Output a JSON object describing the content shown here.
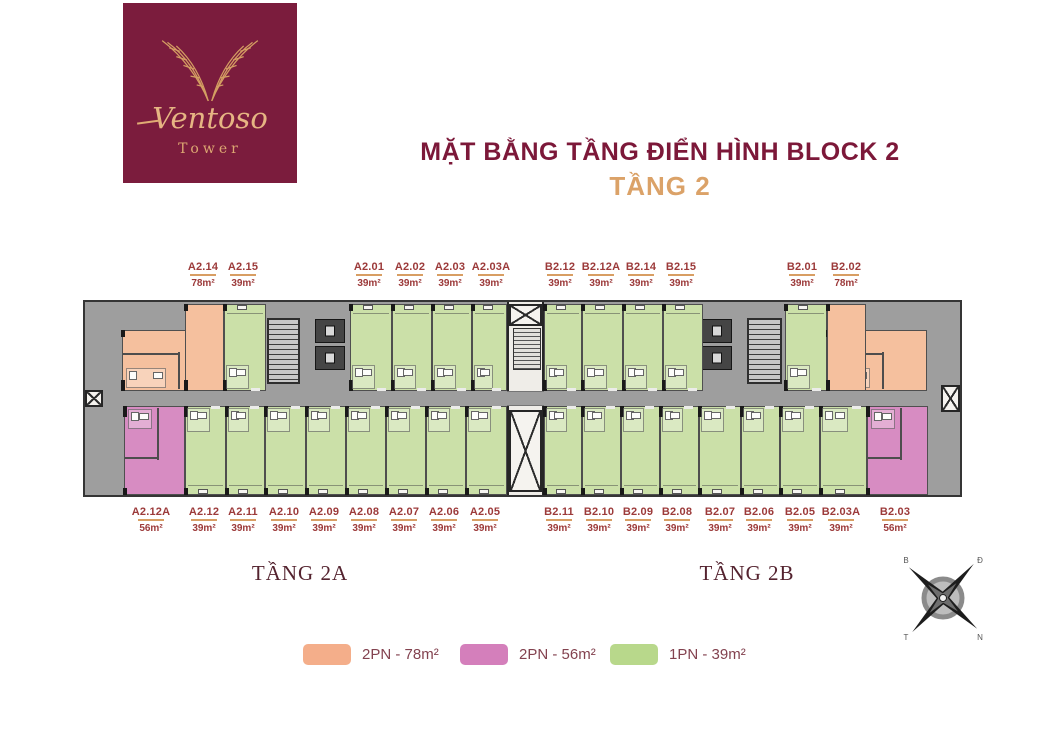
{
  "logo": {
    "brand": "Ventoso",
    "sub": "Tower"
  },
  "title": "MẶT BẰNG TẦNG ĐIỂN HÌNH BLOCK 2",
  "subtitle": "TẦNG 2",
  "wings": {
    "left": "TẦNG 2A",
    "right": "TẦNG 2B"
  },
  "legend": [
    {
      "label": "2PN - 78m²",
      "color": "#f4ae8a",
      "type": "2PN-78"
    },
    {
      "label": "2PN - 56m²",
      "color": "#d47fbb",
      "type": "2PN-56"
    },
    {
      "label": "1PN - 39m²",
      "color": "#b8d88b",
      "type": "1PN-39"
    }
  ],
  "compass": {
    "nw": "B",
    "ne": "Đ",
    "sw": "T",
    "se": "N"
  },
  "colors": {
    "2PN-78": "#f5c09e",
    "2PN-56": "#d78cc2",
    "1PN-39": "#cbe0a8",
    "corridor": "#9e9e9e",
    "wall": "#353535",
    "label_red": "#9c3a3a",
    "rule_gold": "#d89e63",
    "maroon": "#7c1839",
    "gold": "#dba268"
  },
  "plan": {
    "units_top": [
      {
        "id": "A2.14",
        "area": "78m²",
        "type": "2PN-78",
        "rects": [
          [
            37,
            28,
            102,
            61
          ],
          [
            100,
            2,
            39,
            87
          ]
        ],
        "label_x": 203
      },
      {
        "id": "A2.15",
        "area": "39m²",
        "type": "1PN-39",
        "rects": [
          [
            139,
            2,
            42,
            87
          ]
        ],
        "label_x": 243
      },
      {
        "id": "A2.01",
        "area": "39m²",
        "type": "1PN-39",
        "rects": [
          [
            265,
            2,
            42,
            87
          ]
        ],
        "label_x": 369
      },
      {
        "id": "A2.02",
        "area": "39m²",
        "type": "1PN-39",
        "rects": [
          [
            307,
            2,
            40,
            87
          ]
        ],
        "label_x": 410
      },
      {
        "id": "A2.03",
        "area": "39m²",
        "type": "1PN-39",
        "rects": [
          [
            347,
            2,
            40,
            87
          ]
        ],
        "label_x": 450
      },
      {
        "id": "A2.03A",
        "area": "39m²",
        "type": "1PN-39",
        "rects": [
          [
            387,
            2,
            35,
            87
          ]
        ],
        "label_x": 491
      },
      {
        "id": "B2.12",
        "area": "39m²",
        "type": "1PN-39",
        "rects": [
          [
            459,
            2,
            38,
            87
          ]
        ],
        "label_x": 560
      },
      {
        "id": "B2.12A",
        "area": "39m²",
        "type": "1PN-39",
        "rects": [
          [
            497,
            2,
            41,
            87
          ]
        ],
        "label_x": 601
      },
      {
        "id": "B2.14",
        "area": "39m²",
        "type": "1PN-39",
        "rects": [
          [
            538,
            2,
            40,
            87
          ]
        ],
        "label_x": 641
      },
      {
        "id": "B2.15",
        "area": "39m²",
        "type": "1PN-39",
        "rects": [
          [
            578,
            2,
            40,
            87
          ]
        ],
        "label_x": 681
      },
      {
        "id": "B2.01",
        "area": "39m²",
        "type": "1PN-39",
        "rects": [
          [
            700,
            2,
            42,
            87
          ]
        ],
        "label_x": 802
      },
      {
        "id": "B2.02",
        "area": "78m²",
        "type": "2PN-78",
        "rects": [
          [
            742,
            28,
            100,
            61
          ],
          [
            742,
            2,
            39,
            87
          ]
        ],
        "label_x": 846
      }
    ],
    "units_bottom": [
      {
        "id": "A2.12A",
        "area": "56m²",
        "type": "2PN-56",
        "rects": [
          [
            39,
            104,
            61,
            89
          ]
        ],
        "label_x": 151
      },
      {
        "id": "A2.12",
        "area": "39m²",
        "type": "1PN-39",
        "rects": [
          [
            100,
            104,
            41,
            89
          ]
        ],
        "label_x": 204
      },
      {
        "id": "A2.11",
        "area": "39m²",
        "type": "1PN-39",
        "rects": [
          [
            141,
            104,
            39,
            89
          ]
        ],
        "label_x": 243
      },
      {
        "id": "A2.10",
        "area": "39m²",
        "type": "1PN-39",
        "rects": [
          [
            180,
            104,
            41,
            89
          ]
        ],
        "label_x": 284
      },
      {
        "id": "A2.09",
        "area": "39m²",
        "type": "1PN-39",
        "rects": [
          [
            221,
            104,
            40,
            89
          ]
        ],
        "label_x": 324
      },
      {
        "id": "A2.08",
        "area": "39m²",
        "type": "1PN-39",
        "rects": [
          [
            261,
            104,
            40,
            89
          ]
        ],
        "label_x": 364
      },
      {
        "id": "A2.07",
        "area": "39m²",
        "type": "1PN-39",
        "rects": [
          [
            301,
            104,
            40,
            89
          ]
        ],
        "label_x": 404
      },
      {
        "id": "A2.06",
        "area": "39m²",
        "type": "1PN-39",
        "rects": [
          [
            341,
            104,
            40,
            89
          ]
        ],
        "label_x": 444
      },
      {
        "id": "A2.05",
        "area": "39m²",
        "type": "1PN-39",
        "rects": [
          [
            381,
            104,
            41,
            89
          ]
        ],
        "label_x": 485
      },
      {
        "id": "B2.11",
        "area": "39m²",
        "type": "1PN-39",
        "rects": [
          [
            459,
            104,
            38,
            89
          ]
        ],
        "label_x": 559
      },
      {
        "id": "B2.10",
        "area": "39m²",
        "type": "1PN-39",
        "rects": [
          [
            497,
            104,
            39,
            89
          ]
        ],
        "label_x": 599
      },
      {
        "id": "B2.09",
        "area": "39m²",
        "type": "1PN-39",
        "rects": [
          [
            536,
            104,
            39,
            89
          ]
        ],
        "label_x": 638
      },
      {
        "id": "B2.08",
        "area": "39m²",
        "type": "1PN-39",
        "rects": [
          [
            575,
            104,
            39,
            89
          ]
        ],
        "label_x": 677
      },
      {
        "id": "B2.07",
        "area": "39m²",
        "type": "1PN-39",
        "rects": [
          [
            614,
            104,
            42,
            89
          ]
        ],
        "label_x": 720
      },
      {
        "id": "B2.06",
        "area": "39m²",
        "type": "1PN-39",
        "rects": [
          [
            656,
            104,
            39,
            89
          ]
        ],
        "label_x": 759
      },
      {
        "id": "B2.05",
        "area": "39m²",
        "type": "1PN-39",
        "rects": [
          [
            695,
            104,
            40,
            89
          ]
        ],
        "label_x": 800
      },
      {
        "id": "B2.03A",
        "area": "39m²",
        "type": "1PN-39",
        "rects": [
          [
            735,
            104,
            47,
            89
          ]
        ],
        "label_x": 841
      },
      {
        "id": "B2.03",
        "area": "56m²",
        "type": "2PN-56",
        "rects": [
          [
            782,
            104,
            61,
            89
          ]
        ],
        "label_x": 895
      }
    ],
    "infra": [
      {
        "kind": "core",
        "rect": [
          422,
          0,
          37,
          193
        ]
      },
      {
        "kind": "corebar",
        "rect": [
          422,
          89,
          37,
          15
        ]
      },
      {
        "kind": "xbox",
        "rect": [
          424,
          2,
          33,
          22
        ]
      },
      {
        "kind": "util",
        "rect": [
          428,
          26,
          28,
          42
        ]
      },
      {
        "kind": "xbox",
        "rect": [
          424,
          108,
          33,
          82
        ]
      },
      {
        "kind": "stair",
        "rect": [
          182,
          16,
          33,
          66
        ]
      },
      {
        "kind": "elev",
        "rect": [
          230,
          17,
          30,
          24
        ]
      },
      {
        "kind": "elev",
        "rect": [
          230,
          44,
          30,
          24
        ]
      },
      {
        "kind": "elev",
        "rect": [
          617,
          17,
          30,
          24
        ]
      },
      {
        "kind": "elev",
        "rect": [
          617,
          44,
          30,
          24
        ]
      },
      {
        "kind": "stair",
        "rect": [
          662,
          16,
          35,
          66
        ]
      },
      {
        "kind": "xbox",
        "rect": [
          0,
          88,
          18,
          17
        ]
      },
      {
        "kind": "xbox",
        "rect": [
          856,
          83,
          19,
          27
        ]
      }
    ]
  }
}
